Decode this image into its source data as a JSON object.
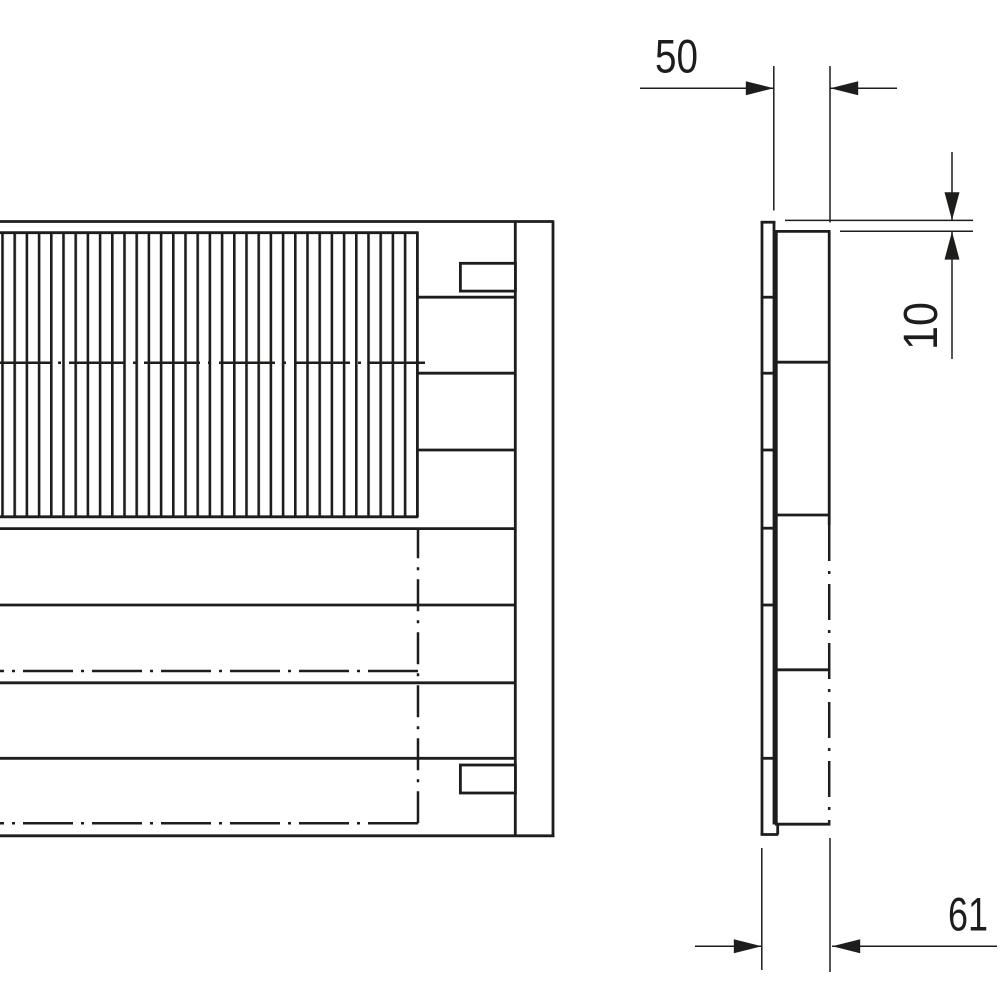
{
  "drawing": {
    "background": "#ffffff",
    "line_color": "#1d1d1b",
    "dimensions": {
      "width": {
        "label": "50"
      },
      "offset": {
        "label": "10"
      },
      "depth": {
        "label": "61"
      }
    }
  }
}
